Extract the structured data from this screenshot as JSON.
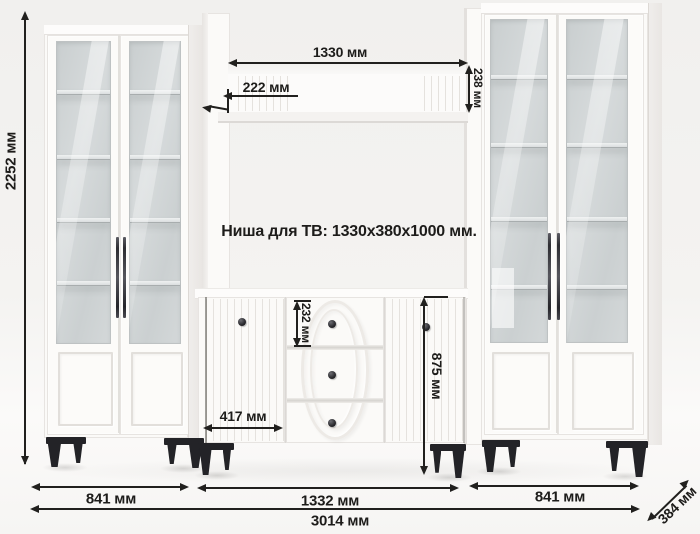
{
  "diagram": {
    "tv_niche_note": "Ниша для ТВ: 1330x380x1000 мм.",
    "dims": {
      "total_height": "2252 мм",
      "shelf_width": "1330 мм",
      "shelf_depth": "222 мм",
      "shelf_face_height": "238 мм",
      "top_drawer_height": "232 мм",
      "chest_height": "875 мм",
      "chest_door_width": "417 мм",
      "left_section_width": "841 мм",
      "center_section_width": "1332 мм",
      "right_section_width": "841 мм",
      "total_width": "3014 мм",
      "unit_depth": "384 мм"
    },
    "colors": {
      "ink": "#21201e",
      "furniture_white": "#fbfaf8",
      "glass": "#ced3d4",
      "legs_black": "#232327",
      "background": "#f2f1ef"
    }
  }
}
